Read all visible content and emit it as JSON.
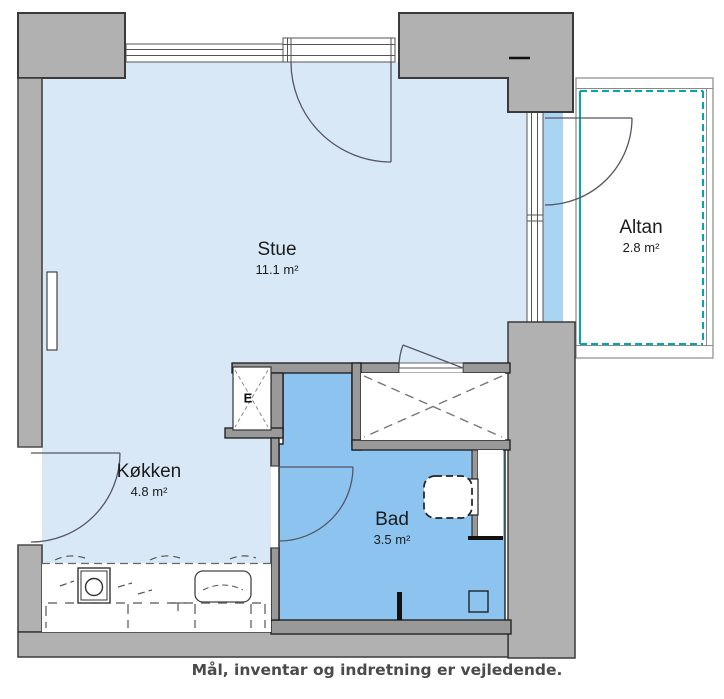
{
  "plan": {
    "rooms": [
      {
        "name": "Stue",
        "area": "11.1 m²"
      },
      {
        "name": "Køkken",
        "area": "4.8 m²"
      },
      {
        "name": "Bad",
        "area": "3.5 m²"
      },
      {
        "name": "Altan",
        "area": "2.8 m²"
      }
    ],
    "closet_label": "E",
    "caption": "Mål, inventar og indretning er vejledende.",
    "colors": {
      "living_floor": "#d9e8f7",
      "wet_floor": "#8dc3ef",
      "balcony_strip": "#a9d4f2",
      "wall_gray": "#b1b1b1",
      "interior_wall_gray": "#999999",
      "railing_teal": "#00a8a8",
      "line_dark": "#3a3a3a"
    }
  }
}
